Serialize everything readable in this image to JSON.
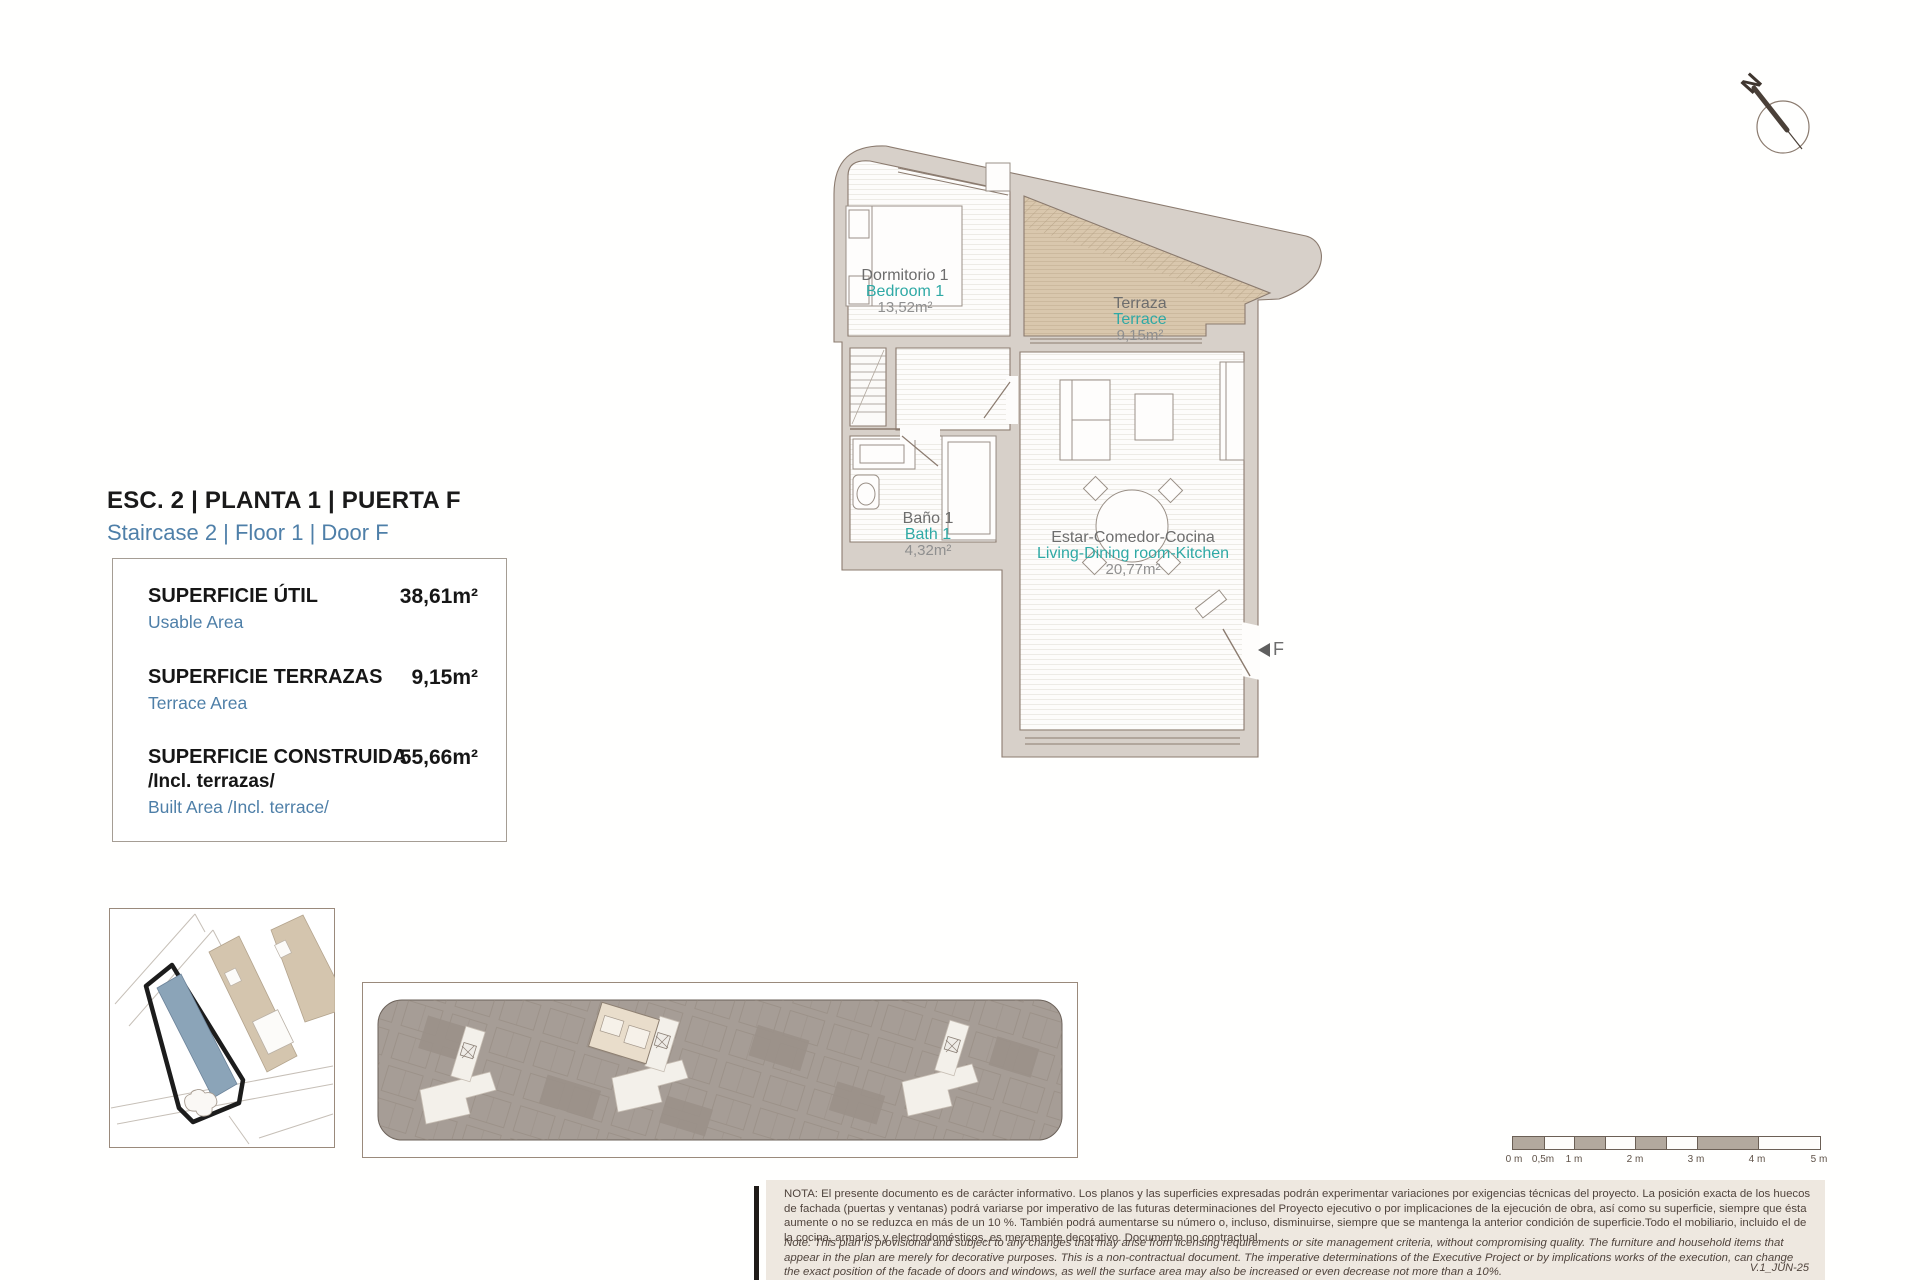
{
  "document": {
    "title": "ESC. 2 | PLANTA 1 | PUERTA F",
    "subtitle": "Staircase 2 | Floor 1 | Door F",
    "version": "V.1_JUN-25"
  },
  "area_panel": {
    "rows": [
      {
        "label": "SUPERFICIE ÚTIL",
        "sublabel": "Usable Area",
        "value": "38,61m²"
      },
      {
        "label": "SUPERFICIE TERRAZAS",
        "sublabel": "Terrace Area",
        "value": "9,15m²"
      },
      {
        "label": "SUPERFICIE CONSTRUIDA",
        "label2": "/Incl. terrazas/",
        "sublabel": "Built Area /Incl. terrace/",
        "value": "55,66m²"
      }
    ]
  },
  "rooms": [
    {
      "name": "Dormitorio 1",
      "name_en": "Bedroom 1",
      "area": "13,52m²"
    },
    {
      "name": "Terraza",
      "name_en": "Terrace",
      "area": "9,15m²"
    },
    {
      "name": "Baño 1",
      "name_en": "Bath 1",
      "area": "4,32m²"
    },
    {
      "name": "Estar-Comedor-Cocina",
      "name_en": "Living-Dining room-Kitchen",
      "area": "20,77m²"
    }
  ],
  "entrance": {
    "door_label": "F"
  },
  "compass": {
    "north_label": "N"
  },
  "scale_bar": {
    "labels": [
      "0 m",
      "0,5m",
      "1 m",
      "2 m",
      "3 m",
      "4 m",
      "5 m"
    ]
  },
  "notes": {
    "es": "NOTA:  El presente documento es de carácter informativo. Los planos y las superficies expresadas podrán experimentar variaciones por exigencias técnicas del proyecto. La posición exacta de los huecos de fachada (puertas y ventanas) podrá variarse por imperativo de las futuras determinaciones del Proyecto ejecutivo o por implicaciones de la ejecución de obra, así como su superficie, siempre que ésta aumente o no se reduzca en más de un 10 %. También podrá aumentarse su número o, incluso, disminuirse, siempre que se mantenga la anterior condición de superficie.Todo el mobiliario, incluido el de la cocina, armarios y electrodomésticos, es meramente decorativo. Documento no contractual.",
    "en": "Note: This plan is provisional and subject to any changes that may arise from licensing requirements or site management criteria, without compromising quality. The furniture and household items that appear in the plan are merely for decorative purposes. This is a non-contractual document. The imperative determinations of the Executive Project or by implications works of the execution, can change the exact position of the facade of doors and windows, as well the surface area may also be increased or even decrease not more than a 10%."
  },
  "colors": {
    "accent_blue": "#4e7fa8",
    "accent_teal": "#2fa9a5",
    "room_gray": "#6d6d6d",
    "wall_fill": "#d7d0c9",
    "wall_stroke": "#8b7b6f",
    "terrace_fill": "#d9c7ad",
    "site_highlight": "#8ba4b8",
    "site_building_tan": "#d4c5ae",
    "keyplan_gray": "#a69d96",
    "scale_gray": "#b3a99e",
    "note_bg": "#eee8e0"
  }
}
